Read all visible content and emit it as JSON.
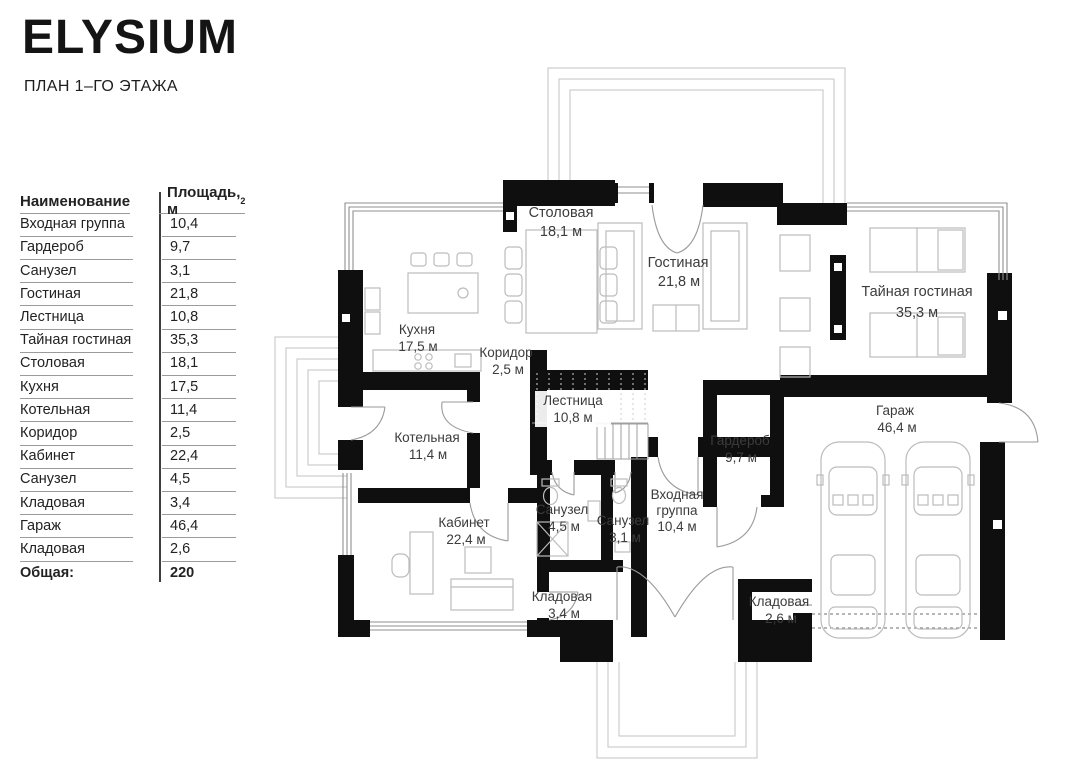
{
  "header": {
    "brand": "ELYSIUM",
    "subtitle": "ПЛАН 1–ГО ЭТАЖА"
  },
  "table": {
    "col_name": "Наименование",
    "col_area": "Площадь, м",
    "col_area_sup": "2",
    "rows": [
      {
        "name": "Входная группа",
        "area": "10,4"
      },
      {
        "name": "Гардероб",
        "area": "9,7"
      },
      {
        "name": "Санузел",
        "area": "3,1"
      },
      {
        "name": "Гостиная",
        "area": "21,8"
      },
      {
        "name": "Лестница",
        "area": "10,8"
      },
      {
        "name": "Тайная гостиная",
        "area": "35,3"
      },
      {
        "name": "Столовая",
        "area": "18,1"
      },
      {
        "name": "Кухня",
        "area": "17,5"
      },
      {
        "name": "Котельная",
        "area": "11,4"
      },
      {
        "name": "Коридор",
        "area": "2,5"
      },
      {
        "name": "Кабинет",
        "area": "22,4"
      },
      {
        "name": "Санузел",
        "area": "4,5"
      },
      {
        "name": "Кладовая",
        "area": "3,4"
      },
      {
        "name": "Гараж",
        "area": "46,4"
      },
      {
        "name": "Кладовая",
        "area": "2,6"
      }
    ],
    "total_label": "Общая:",
    "total_value": "220"
  },
  "plan": {
    "rooms": [
      {
        "label": "Столовая",
        "area": "18,1 м"
      },
      {
        "label": "Гостиная",
        "area": "21,8 м"
      },
      {
        "label": "Тайная гостиная",
        "area": "35,3 м"
      },
      {
        "label": "Кухня",
        "area": "17,5 м"
      },
      {
        "label": "Коридор",
        "area": "2,5 м"
      },
      {
        "label": "Лестница",
        "area": "10,8 м"
      },
      {
        "label": "Котельная",
        "area": "11,4 м"
      },
      {
        "label": "Гардероб",
        "area": "9,7 м"
      },
      {
        "label": "Гараж",
        "area": "46,4 м"
      },
      {
        "label": "Кабинет",
        "area": "22,4 м"
      },
      {
        "label": "Санузел",
        "area": "4,5 м"
      },
      {
        "label": "Санузел",
        "area": "3,1 м"
      },
      {
        "label1": "Входная",
        "label2": "группа",
        "area": "10,4 м"
      },
      {
        "label": "Кладовая",
        "area": "3,4 м"
      },
      {
        "label": "Кладовая",
        "area": "2,6 м"
      }
    ],
    "colors": {
      "wall": "#0f0f0f",
      "furniture": "#bcbcbc",
      "label": "#3c3c3c"
    }
  }
}
